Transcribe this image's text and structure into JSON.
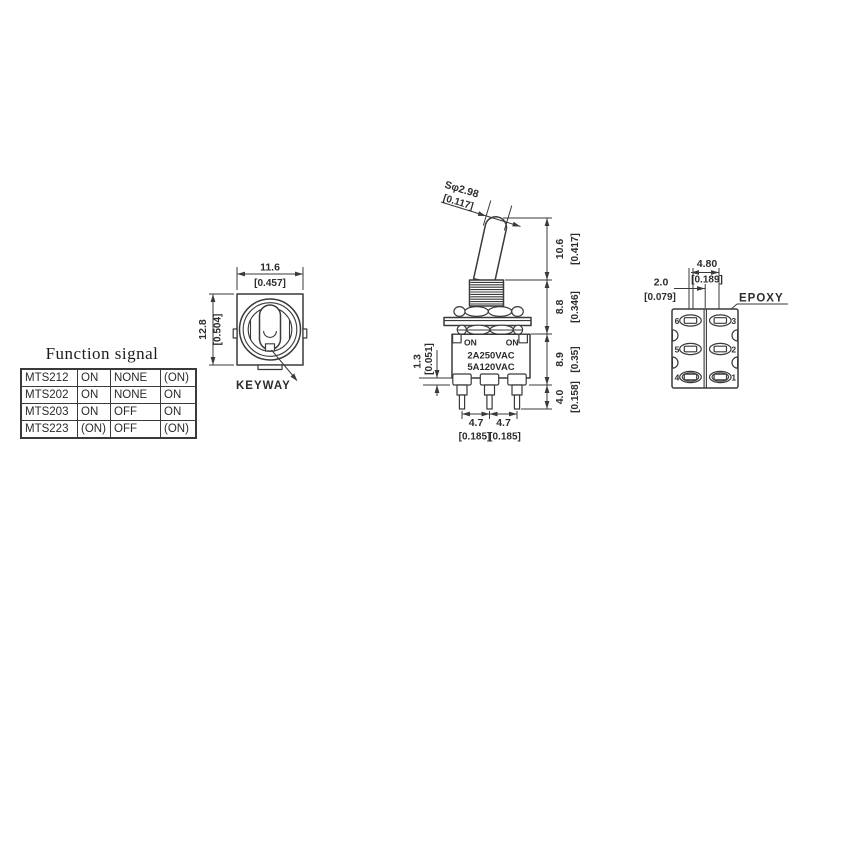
{
  "colors": {
    "line": "#3a3a3a",
    "text": "#2d2d2d",
    "background": "#ffffff"
  },
  "function_signal": {
    "title": "Function signal",
    "rows": [
      {
        "model": "MTS212",
        "pos1": "ON",
        "pos2": "NONE",
        "pos3": "(ON)"
      },
      {
        "model": "MTS202",
        "pos1": "ON",
        "pos2": "NONE",
        "pos3": "ON"
      },
      {
        "model": "MTS203",
        "pos1": "ON",
        "pos2": "OFF",
        "pos3": "ON"
      },
      {
        "model": "MTS223",
        "pos1": "(ON)",
        "pos2": "OFF",
        "pos3": "(ON)"
      }
    ]
  },
  "front_view": {
    "width_mm": "11.6",
    "width_in": "[0.457]",
    "height_mm": "12.8",
    "height_in": "[0.504]",
    "keyway_label": "KEYWAY"
  },
  "side_view": {
    "actuator_dia_mm": "Sφ2.98",
    "actuator_dia_in": "[0.117]",
    "actuator_len_mm": "10.6",
    "actuator_len_in": "[0.417]",
    "bushing_len_mm": "8.8",
    "bushing_len_in": "[0.346]",
    "body_len_mm": "8.9",
    "body_len_in": "[0.35]",
    "terminal_len_mm": "4.0",
    "terminal_len_in": "[0.158]",
    "standoff_mm": "1.3",
    "standoff_in": "[0.051]",
    "pitch_left_mm": "4.7",
    "pitch_left_in": "[0.185]",
    "pitch_right_mm": "4.7",
    "pitch_right_in": "[0.185]",
    "marking_on_left": "ON",
    "marking_on_right": "ON",
    "rating_line1": "2A250VAC",
    "rating_line2": "5A120VAC"
  },
  "bottom_view": {
    "spacing_mm": "4.80",
    "spacing_in": "[0.189]",
    "offset_mm": "2.0",
    "offset_in": "[0.079]",
    "epoxy_label": "EPOXY",
    "pins": {
      "p1": "1",
      "p2": "2",
      "p3": "3",
      "p4": "4",
      "p5": "5",
      "p6": "6"
    }
  }
}
